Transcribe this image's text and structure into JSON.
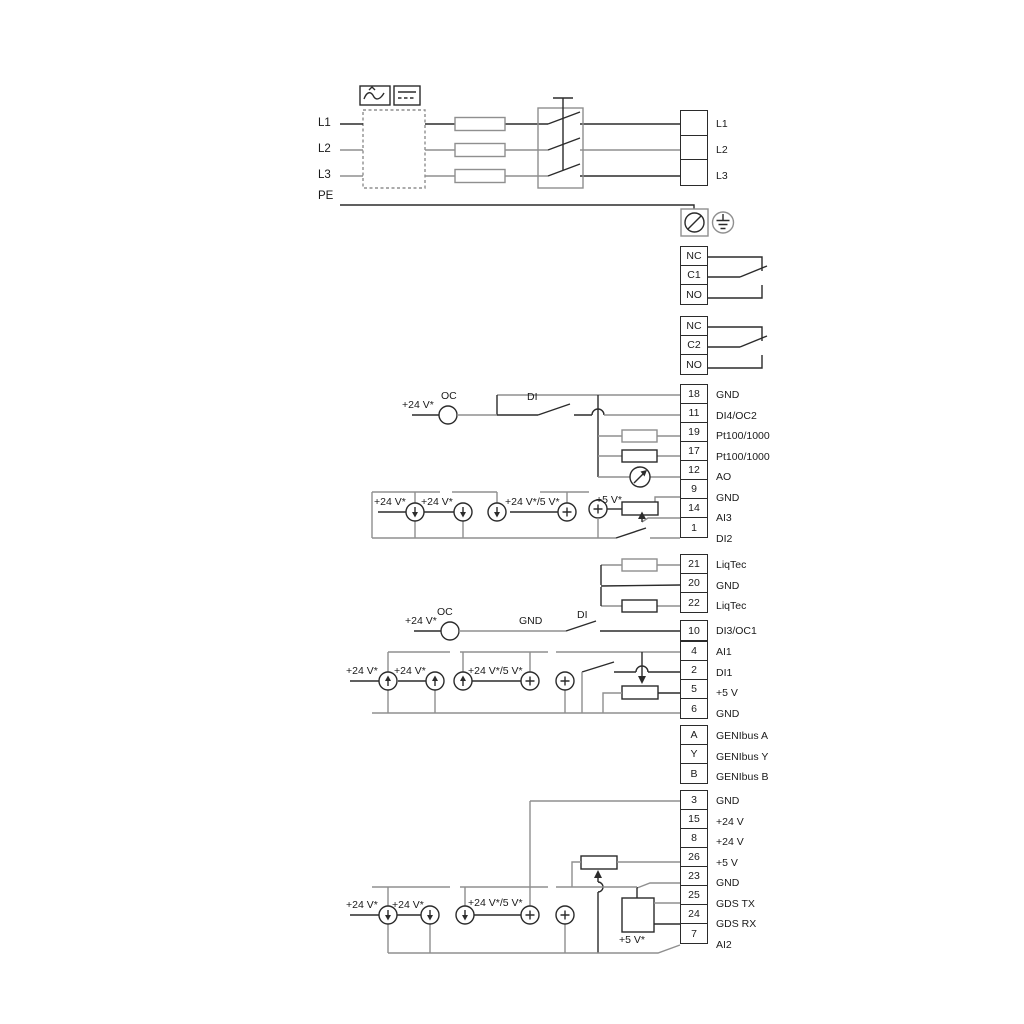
{
  "power": {
    "inputs": [
      "L1",
      "L2",
      "L3"
    ],
    "pe": "PE",
    "outputs": [
      "L1",
      "L2",
      "L3"
    ]
  },
  "relays": {
    "relay1": [
      "NC",
      "C1",
      "NO"
    ],
    "relay2": [
      "NC",
      "C2",
      "NO"
    ]
  },
  "terminals": {
    "io_top": [
      {
        "num": "18",
        "label": "GND"
      },
      {
        "num": "11",
        "label": "DI4/OC2"
      },
      {
        "num": "19",
        "label": "Pt100/1000"
      },
      {
        "num": "17",
        "label": "Pt100/1000"
      },
      {
        "num": "12",
        "label": "AO"
      },
      {
        "num": "9",
        "label": "GND"
      },
      {
        "num": "14",
        "label": "AI3"
      },
      {
        "num": "1",
        "label": "DI2"
      }
    ],
    "liqtec": [
      {
        "num": "21",
        "label": "LiqTec"
      },
      {
        "num": "20",
        "label": "GND"
      },
      {
        "num": "22",
        "label": "LiqTec"
      }
    ],
    "di3": [
      {
        "num": "10",
        "label": "DI3/OC1"
      }
    ],
    "ai1": [
      {
        "num": "4",
        "label": "AI1"
      },
      {
        "num": "2",
        "label": "DI1"
      },
      {
        "num": "5",
        "label": "+5 V"
      },
      {
        "num": "6",
        "label": "GND"
      }
    ],
    "genibus": [
      {
        "num": "A",
        "label": "GENIbus A"
      },
      {
        "num": "Y",
        "label": "GENIbus Y"
      },
      {
        "num": "B",
        "label": "GENIbus B"
      }
    ],
    "bottom": [
      {
        "num": "3",
        "label": "GND"
      },
      {
        "num": "15",
        "label": "+24 V"
      },
      {
        "num": "8",
        "label": "+24 V"
      },
      {
        "num": "26",
        "label": "+5 V"
      },
      {
        "num": "23",
        "label": "GND"
      },
      {
        "num": "25",
        "label": "GDS TX"
      },
      {
        "num": "24",
        "label": "GDS RX"
      },
      {
        "num": "7",
        "label": "AI2"
      }
    ]
  },
  "annotations": {
    "oc1_plus24": "+24 V*",
    "oc1": "OC",
    "di4": "DI",
    "ai3_plus24_a": "+24 V*",
    "ai3_plus24_b": "+24 V*",
    "ai3_mixed": "+24 V*/5 V*",
    "ai3_plus5": "+5 V*",
    "oc2_plus24": "+24 V*",
    "oc2": "OC",
    "di3_gnd": "GND",
    "di3": "DI",
    "ai1_plus24_a": "+24 V*",
    "ai1_plus24_b": "+24 V*",
    "ai1_mixed": "+24 V*/5 V*",
    "ai2_plus24_a": "+24 V*",
    "ai2_plus24_b": "+24 V*",
    "ai2_mixed": "+24 V*/5 V*",
    "ai2_plus5": "+5 V*"
  },
  "colors": {
    "wire_gray": "#8f8f8f",
    "line_dark": "#2b2b2b",
    "background": "#ffffff"
  }
}
